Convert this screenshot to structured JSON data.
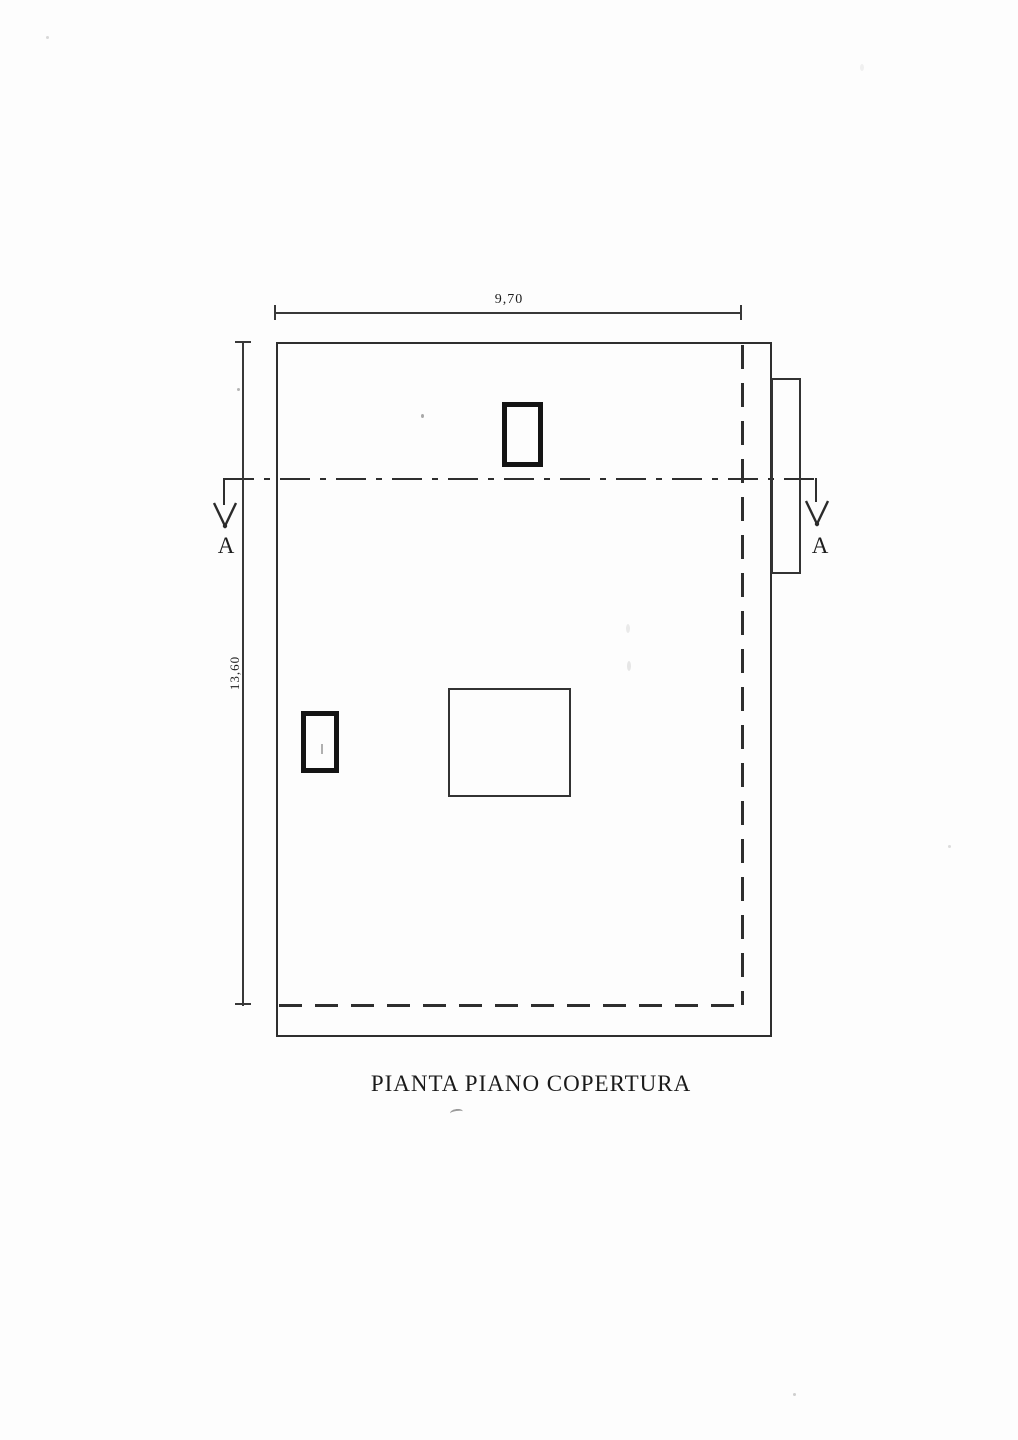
{
  "drawing": {
    "title": "PIANTA PIANO COPERTURA",
    "dimensions": {
      "top": "9,70",
      "left": "13,60"
    },
    "section": {
      "left_label": "A",
      "right_label": "A"
    },
    "colors": {
      "background": "#fdfdfd",
      "line": "#2e2e2e",
      "dimension_line": "#383838",
      "chimney_line": "#141414",
      "text": "#1d1d1d"
    }
  }
}
